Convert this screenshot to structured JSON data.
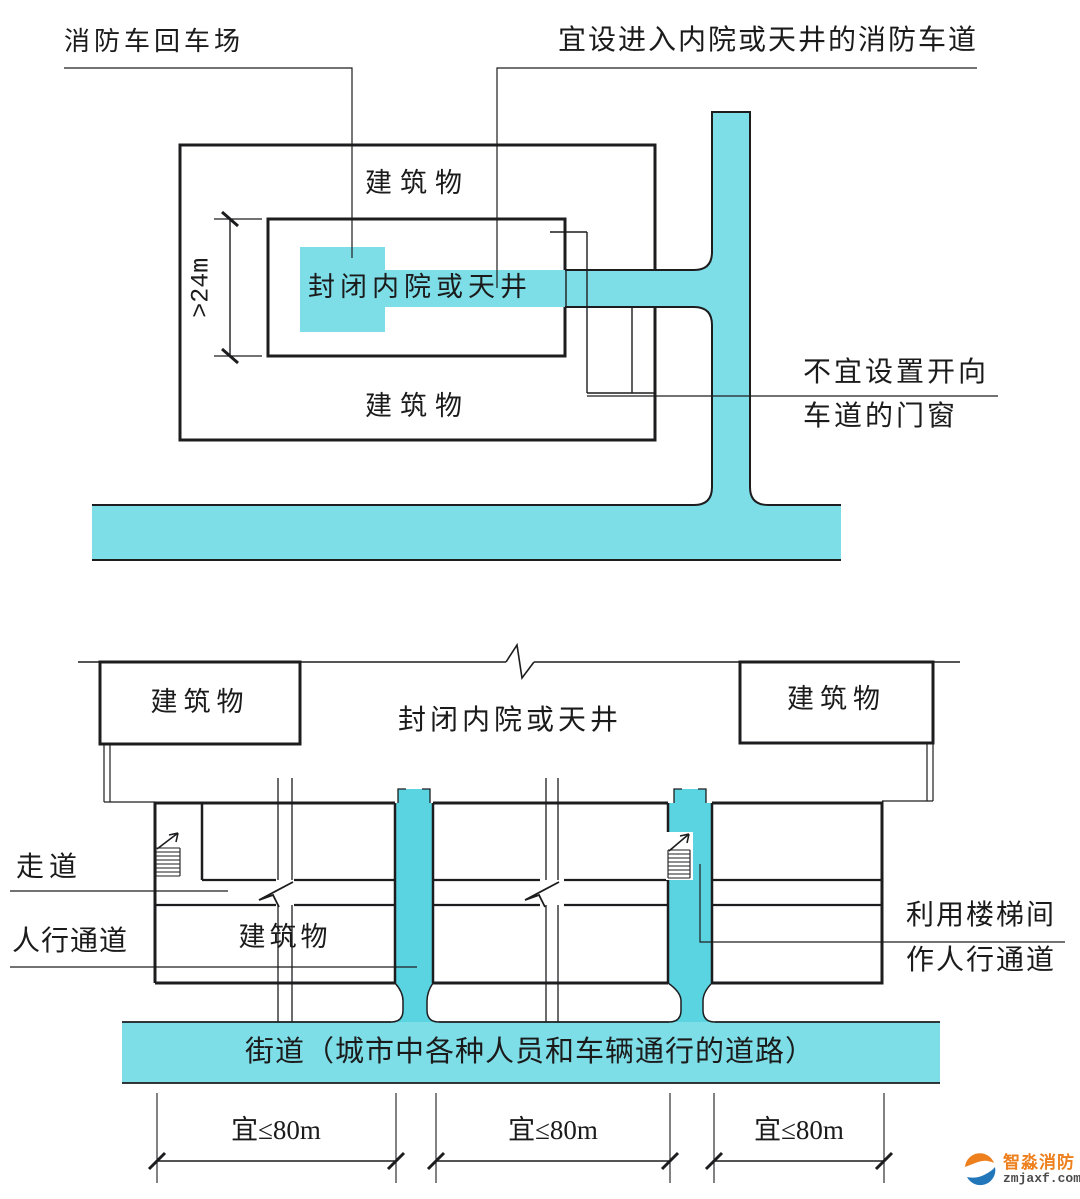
{
  "palette": {
    "road_cyan": "#7edee8",
    "passage_cyan": "#5bd4e2",
    "line_black": "#1d1d1f",
    "text_black": "#1b1b1b",
    "logo_orange": "#ee7f1d",
    "logo_blue": "#2277bb"
  },
  "top_diagram": {
    "turnaround_label": "消防车回车场",
    "lane_label": "宜设进入内院或天井的消防车道",
    "building_top": "建筑物",
    "building_bottom": "建筑物",
    "courtyard_label": "封闭内院或天井",
    "dimension_label": ">24m",
    "window_note_line1": "不宜设置开向",
    "window_note_line2": "车道的门窗"
  },
  "bottom_diagram": {
    "building_left": "建筑物",
    "building_right": "建筑物",
    "courtyard_label": "封闭内院或天井",
    "corridor_label": "走道",
    "building_strip": "建筑物",
    "pedestrian_label": "人行通道",
    "stair_note_line1": "利用楼梯间",
    "stair_note_line2": "作人行通道",
    "street_label": "街道（城市中各种人员和车辆通行的道路）",
    "dims": [
      "宜≤80m",
      "宜≤80m",
      "宜≤80m"
    ]
  },
  "watermark": {
    "brand": "智淼消防",
    "domain": "zmjaxf.com"
  }
}
